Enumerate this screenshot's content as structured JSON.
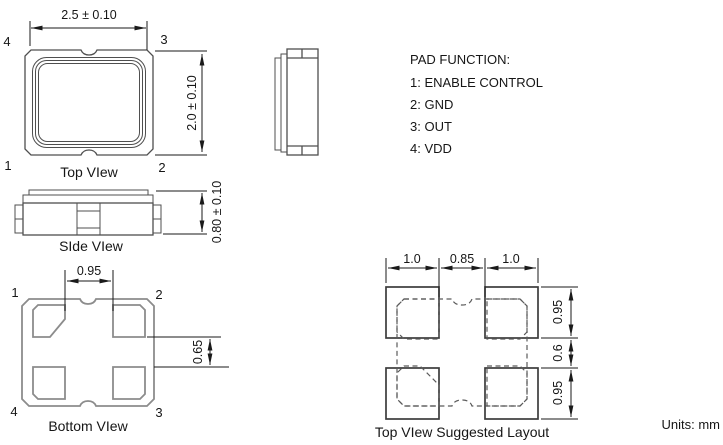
{
  "drawing": {
    "units_label": "Units: mm",
    "pad_function": {
      "title": "PAD FUNCTION:",
      "line1": "1: ENABLE CONTROL",
      "line2": "2: GND",
      "line3": "3: OUT",
      "line4": "4: VDD"
    },
    "top_view": {
      "caption": "Top VIew",
      "dim_width": "2.5 ± 0.10",
      "dim_height": "2.0 ± 0.10",
      "pin_top_left": "4",
      "pin_top_right": "3",
      "pin_bottom_left": "1",
      "pin_bottom_right": "2"
    },
    "side_view": {
      "caption": "SIde VIew",
      "dim_height": "0.80 ± 0.10"
    },
    "bottom_view": {
      "caption": "Bottom VIew",
      "dim_pad_gap_h": "0.95",
      "dim_pad_gap_v": "0.65",
      "pin_top_left": "1",
      "pin_top_right": "2",
      "pin_bottom_left": "4",
      "pin_bottom_right": "3"
    },
    "suggested_layout": {
      "caption": "Top VIew Suggested Layout",
      "dim_pad_w_left": "1.0",
      "dim_gap_h": "0.85",
      "dim_pad_w_right": "1.0",
      "dim_pad_h_top": "0.95",
      "dim_gap_v": "0.6",
      "dim_pad_h_bottom": "0.95"
    },
    "colors": {
      "background": "#ffffff",
      "geometry_line": "#4f4f4f",
      "geometry_gray": "#8c8c8c",
      "dimension_line": "#1a1a1a",
      "text": "#161616"
    }
  }
}
